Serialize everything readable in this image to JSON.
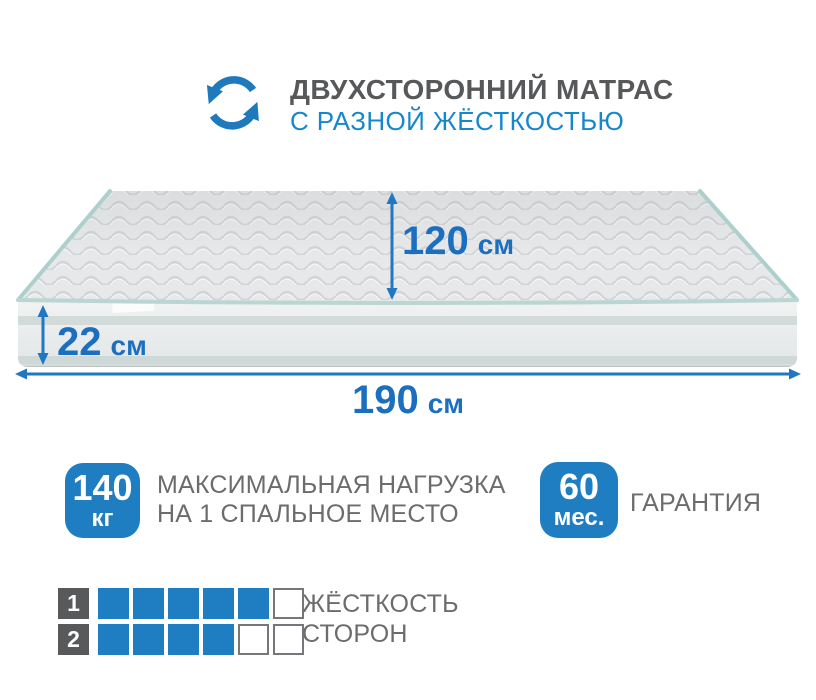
{
  "header": {
    "title": "ДВУХСТОРОННИЙ МАТРАС",
    "subtitle": "С РАЗНОЙ ЖЁСТКОСТЬЮ",
    "icon": "rotation-arrows-icon"
  },
  "mattress": {
    "depth": {
      "value": "120",
      "unit": "см"
    },
    "height": {
      "value": "22",
      "unit": "см"
    },
    "length": {
      "value": "190",
      "unit": "см"
    }
  },
  "load_badge": {
    "value": "140",
    "unit": "кг",
    "line1": "МАКСИМАЛЬНАЯ НАГРУЗКА",
    "line2": "НА 1 СПАЛЬНОЕ МЕСТО"
  },
  "warranty_badge": {
    "value": "60",
    "unit": "мес.",
    "label": "ГАРАНТИЯ"
  },
  "firmness": {
    "line1": "ЖЁСТКОСТЬ",
    "line2": "СТОРОН",
    "rows": [
      {
        "side": "1",
        "filled": 5,
        "total": 6
      },
      {
        "side": "2",
        "filled": 4,
        "total": 6
      }
    ]
  },
  "colors": {
    "accent_blue": "#1f7dc1",
    "dimension_blue": "#1b6fbe",
    "subtitle_blue": "#1787cd",
    "title_gray": "#57585a",
    "text_gray": "#6b6c6e",
    "square_dark": "#58595b",
    "piping_teal": "#aed0cd"
  }
}
